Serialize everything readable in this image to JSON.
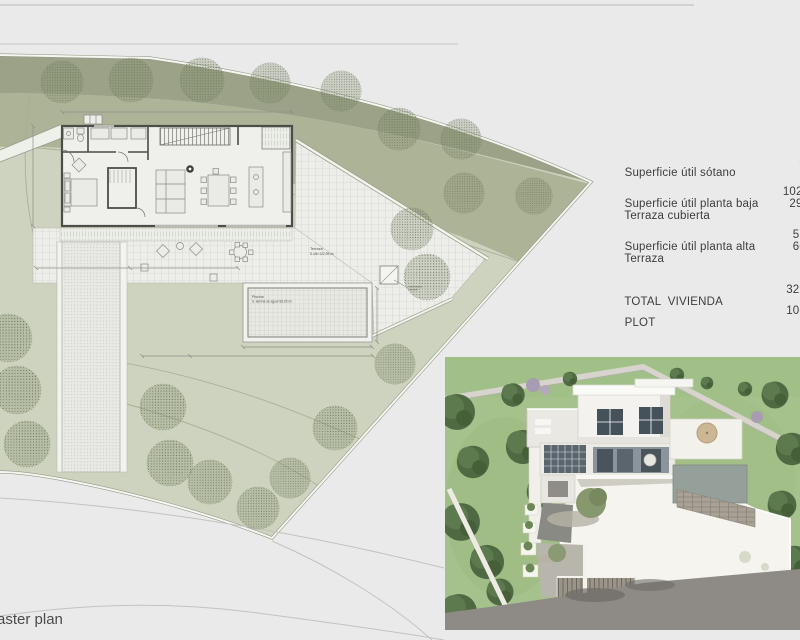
{
  "area_table": {
    "rows": [
      {
        "label": "Superficie útil sótano",
        "value": "8"
      },
      {
        "label": "Superficie útil planta baja",
        "value": "102,"
      },
      {
        "label": "Terraza cubierta",
        "value": "29,"
      },
      {
        "label": "Superficie útil planta alta",
        "value": "57"
      },
      {
        "label": "Terraza",
        "value": "60"
      },
      {
        "label": "TOTAL  VIVIENDA",
        "value": "329"
      },
      {
        "label": "PLOT",
        "value": "108"
      }
    ]
  },
  "plan": {
    "caption": "aster plan",
    "labels": {
      "terrace": {
        "line1": "Terraza",
        "line2": "S.útil=122,95 m²"
      },
      "pool": {
        "line1": "Piscina",
        "line2": "S. lámina de agua=36,00 m²"
      }
    }
  },
  "palette": {
    "terrain_dark": "#9ba287",
    "terrain_mid": "#adb397",
    "terrain_light": "#cdd3be",
    "paper": "#eaeaea",
    "render_lawn": "#a6c28c",
    "render_road": "#8e8b86",
    "text": "#3d3d3d"
  }
}
